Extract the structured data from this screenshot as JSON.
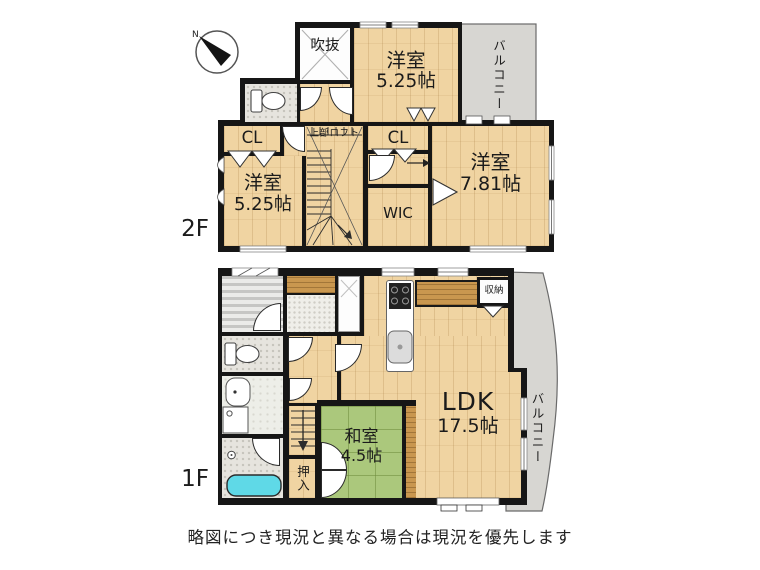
{
  "compass": {
    "label": "N"
  },
  "floor2": {
    "label": "2F",
    "void_label": "吹抜",
    "bedroom_top": {
      "name": "洋室",
      "size": "5.25帖"
    },
    "balcony_label": "バルコニー",
    "closet_left_label": "CL",
    "bedroom_left": {
      "name": "洋室",
      "size": "5.25帖"
    },
    "loft_label": "上部ロフト",
    "closet_mid_label": "CL",
    "wic_label": "WIC",
    "bedroom_right": {
      "name": "洋室",
      "size": "7.81帖"
    }
  },
  "floor1": {
    "label": "1F",
    "storage_label": "収納",
    "ldk": {
      "name": "LDK",
      "size": "17.5帖"
    },
    "balcony_label": "バルコニー",
    "japanese_room": {
      "name": "和室",
      "size": "4.5帖"
    },
    "oshiire_label": "押入"
  },
  "footer": {
    "disclaimer": "略図につき現況と異なる場合は現況を優先します"
  },
  "colors": {
    "wall": "#161616",
    "wood": "#f0d4a2",
    "tatami": "#abc87c",
    "balcony": "#d7d6d2",
    "bathtub": "#5fd9e7"
  }
}
